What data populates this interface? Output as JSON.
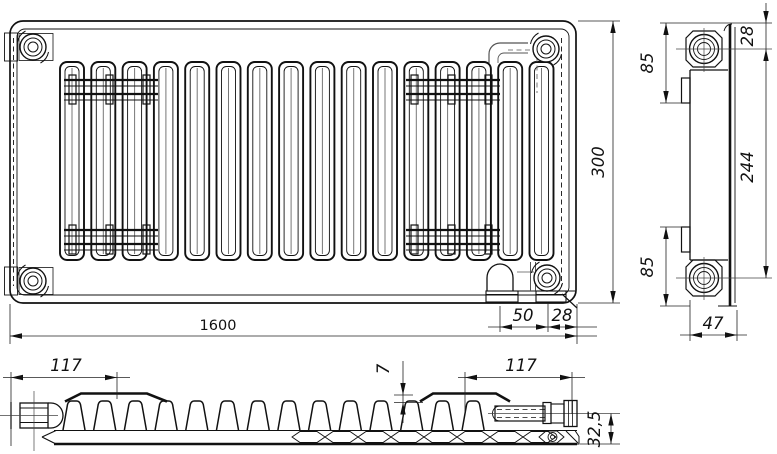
{
  "drawing": {
    "front_view": {
      "length": "1600",
      "valve_offset": "50",
      "end_offset": "28",
      "height": "300"
    },
    "side_view": {
      "top_connection_offset": "28",
      "upper_bracket_height": "85",
      "connection_spacing": "244",
      "lower_bracket_height": "85",
      "depth": "47"
    },
    "top_view": {
      "left_bracket_offset": "117",
      "cover_step": "7",
      "right_bracket_offset": "117",
      "bottom_connection_offset": "32,5"
    }
  }
}
